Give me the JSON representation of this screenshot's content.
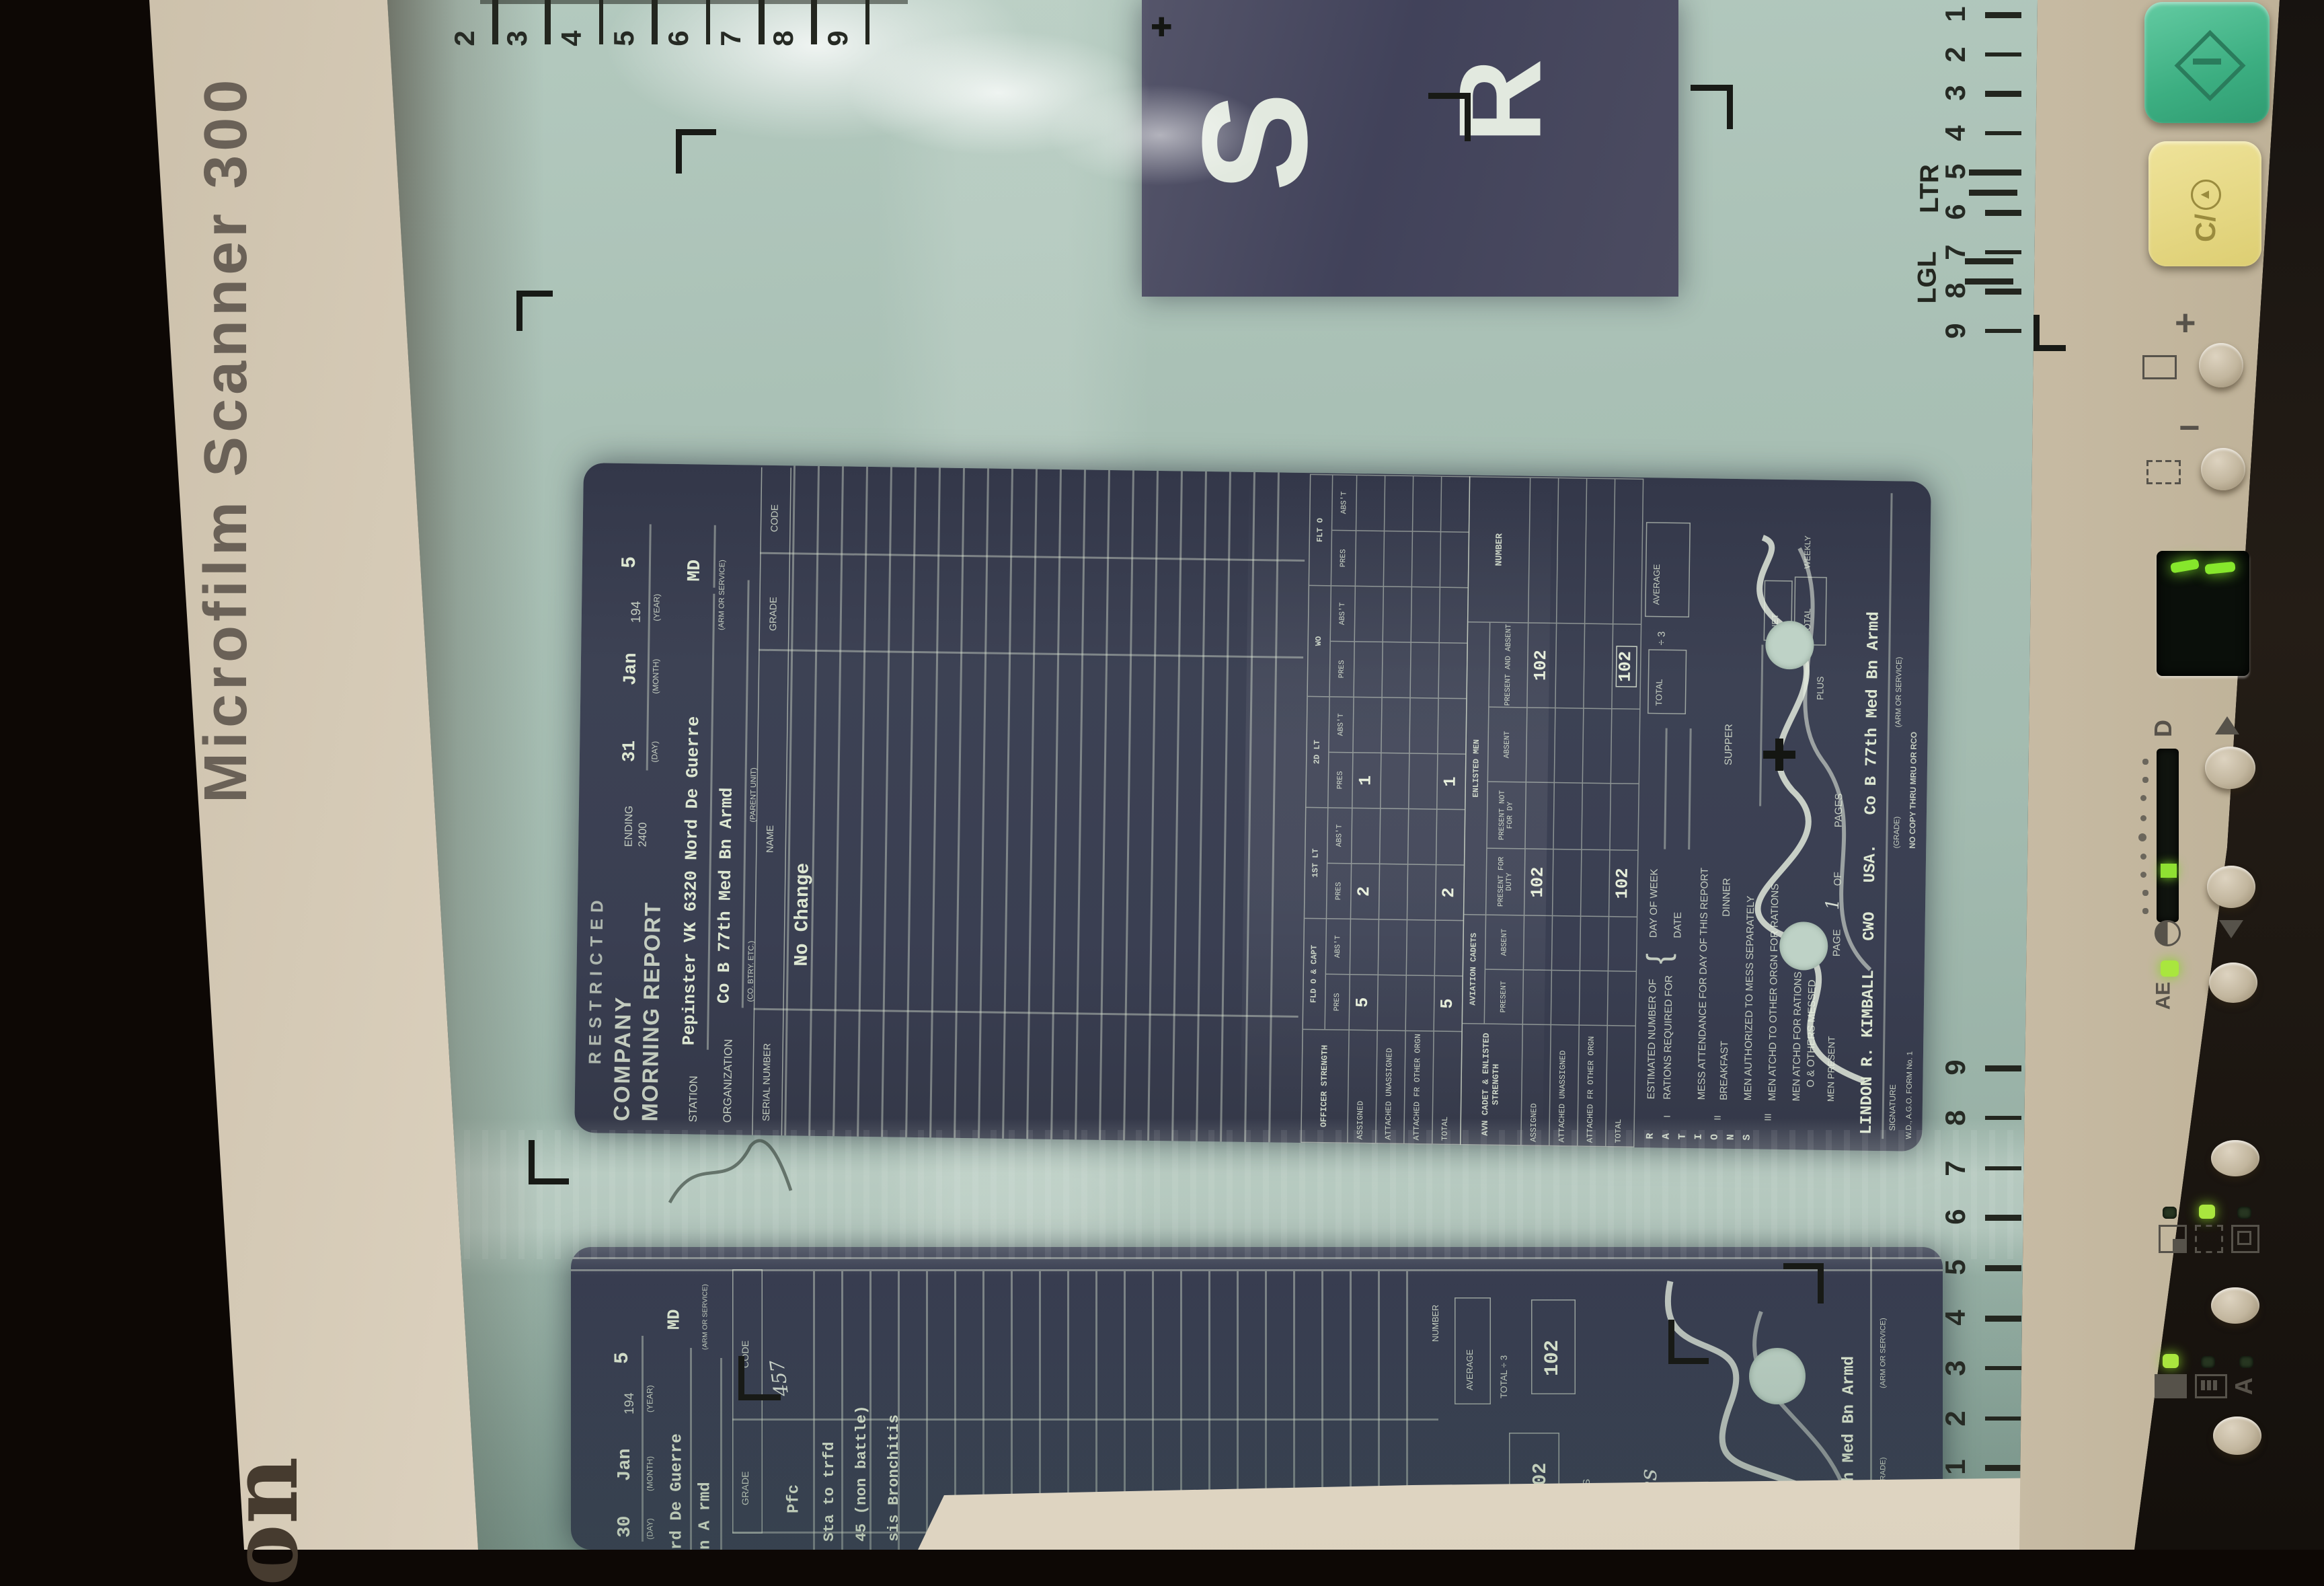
{
  "device": {
    "model_label": "Microfilm Scanner 300",
    "brand_logo_fragment": "on",
    "colors": {
      "bezel": "#d7ccb8",
      "screen_glass": "#a9c0b5",
      "document_film": "#3a3f52",
      "start_button_green": "#45b58c",
      "clear_button_yellow": "#e6da84",
      "led_green": "#a9e63e",
      "segment_green": "#86e72c",
      "ruler_ink": "#23261f"
    }
  },
  "screen": {
    "top_ruler_numbers": [
      "2",
      "3",
      "4",
      "5",
      "6",
      "7",
      "8",
      "9"
    ],
    "right_ruler_top": {
      "numbers": [
        "1",
        "2",
        "3",
        "4",
        "5",
        "6",
        "7",
        "8",
        "9"
      ],
      "letter_label": "LTR",
      "legal_label": "LGL"
    },
    "right_ruler_bottom_numbers": [
      "9",
      "8",
      "7",
      "6",
      "5",
      "4",
      "3",
      "2",
      "1"
    ],
    "film_title_letters": {
      "letter1": "S",
      "letter2": "R"
    }
  },
  "main_document": {
    "classification_stamp": "RESTRICTED",
    "title_line1": "COMPANY",
    "title_line2": "MORNING REPORT",
    "ending_label": "ENDING",
    "ending_time": "2400",
    "date": {
      "day": "31",
      "month": "Jan",
      "year_printed": "194",
      "year_written": "5",
      "day_label": "(DAY)",
      "month_label": "(MONTH)",
      "year_label": "(YEAR)"
    },
    "station_label": "STATION",
    "station_value": "Pepinster VK 6320 Nord De Guerre",
    "arm_value": "MD",
    "arm_label": "(ARM OR SERVICE)",
    "organization_label": "ORGANIZATION",
    "organization_value": "Co B 77th Med Bn Armd",
    "organization_sub": "(CO. BTRY. ETC.)",
    "parent_unit_label": "(PARENT UNIT)",
    "roster": {
      "headers": [
        "SERIAL NUMBER",
        "NAME",
        "GRADE",
        "CODE"
      ],
      "entry": "No Change"
    },
    "officer_table": {
      "label": "OFFICER STRENGTH",
      "groups": [
        "FLD O & CAPT",
        "1ST LT",
        "2D LT",
        "WO",
        "FLT O"
      ],
      "sub": [
        "PRES",
        "ABS'T"
      ],
      "rows": [
        {
          "label": "ASSIGNED",
          "values": [
            "5",
            "",
            "2",
            "",
            "1",
            "",
            "",
            "",
            "",
            ""
          ]
        },
        {
          "label": "ATTACHED UNASSIGNED",
          "values": [
            "",
            "",
            "",
            "",
            "",
            "",
            "",
            "",
            "",
            ""
          ]
        },
        {
          "label": "ATTACHED FR OTHER ORGN",
          "values": [
            "",
            "",
            "",
            "",
            "",
            "",
            "",
            "",
            "",
            ""
          ]
        },
        {
          "label": "TOTAL",
          "values": [
            "5",
            "",
            "2",
            "",
            "1",
            "",
            "",
            "",
            "",
            ""
          ]
        }
      ]
    },
    "cadet_table": {
      "label": "AVN CADET & ENLISTED STRENGTH",
      "group1": "AVIATION CADETS",
      "group2": "ENLISTED MEN",
      "number_header": "NUMBER",
      "sub": [
        "PRESENT",
        "ABSENT",
        "PRESENT FOR DUTY",
        "PRESENT NOT FOR DY",
        "ABSENT",
        "PRESENT AND ABSENT"
      ],
      "rows": [
        {
          "label": "ASSIGNED",
          "values": [
            "",
            "",
            "102",
            "",
            "",
            "102"
          ],
          "number": "",
          "boxed": -1
        },
        {
          "label": "ATTACHED UNASSIGNED",
          "values": [
            "",
            "",
            "",
            "",
            "",
            ""
          ],
          "number": "",
          "boxed": -1
        },
        {
          "label": "ATTACHED FR OTHER ORGN",
          "values": [
            "",
            "",
            "",
            "",
            "",
            ""
          ],
          "number": "",
          "boxed": -1
        },
        {
          "label": "TOTAL",
          "values": [
            "",
            "",
            "102",
            "",
            "",
            "102"
          ],
          "number": "",
          "boxed": 5
        }
      ]
    },
    "rations": {
      "section_label": "RATIONS",
      "numeral_1": "I",
      "numeral_2": "II",
      "numeral_3": "III",
      "estimated_line1": "ESTIMATED NUMBER OF",
      "estimated_line2": "RATIONS REQUIRED FOR",
      "day_of_week_label": "DAY OF WEEK",
      "date_label": "DATE",
      "total_label": "TOTAL",
      "divide_label": "÷ 3",
      "average_label": "AVERAGE",
      "mess_attendance_label": "MESS ATTENDANCE FOR DAY OF THIS REPORT",
      "breakfast_label": "BREAKFAST",
      "dinner_label": "DINNER",
      "supper_label": "SUPPER",
      "mess_separately_label": "MEN AUTHORIZED TO MESS SEPARATELY",
      "atchd_other_label": "MEN ATCHD TO OTHER ORGN FOR RATIONS",
      "atchd_rations_line1": "MEN ATCHD FOR RATIONS",
      "atchd_rations_line2": "O & OTHERS MESSED",
      "net_label": "NET",
      "plus_label": "PLUS",
      "weekly_label": "WEEKLY",
      "total2_label": "TOTAL",
      "men_present_label": "MEN PRESENT"
    },
    "signature_block": {
      "page_label": "PAGE",
      "page_value": "1",
      "of_label": "OF",
      "pages_label": "PAGES",
      "signer_line": "LINDON R. KIMBALL   CWO   USA.   Co B 77th Med Bn Armd",
      "signature_label": "SIGNATURE",
      "grade_label": "(GRADE)",
      "arm_label": "(ARM OR SERVICE)",
      "form_number": "W.D., A.G.O. FORM No. 1",
      "copy_note": "NO COPY THRU MRU OR RCO"
    }
  },
  "next_document": {
    "date": {
      "day": "30",
      "month": "Jan",
      "year_printed": "194",
      "year_written": "5",
      "day_label": "(DAY)",
      "month_label": "(MONTH)",
      "year_label": "(YEAR)"
    },
    "station_fragment": "rd De Guerre",
    "arm_value": "MD",
    "organization_fragment": "n A rmd",
    "arm_label": "(ARM OR SERVICE)",
    "grade_header": "GRADE",
    "code_header": "CODE",
    "entry_grade": "Pfc",
    "code_written": "457",
    "entry_line1": "Sta to trfd",
    "entry_line2": "45 (non battle)",
    "entry_line3": "sis Bronchitis",
    "number_label": "NUMBER",
    "average_label": "AVERAGE",
    "divide_note": "TOTAL ÷ 3",
    "total_label": "TOTAL",
    "total_value": "102",
    "number_value": "102",
    "plus_label": "PLUS",
    "page_written": "ges",
    "organization_line": "o B 77th Med Bn Armd",
    "grade_label": "(GRADE)",
    "arm_sub_label": "(ARM OR SERVICE)"
  },
  "control_panel": {
    "start_button_icon": "diamond-bar-icon",
    "clear_button_label": "C/",
    "zoom_in_label": "+",
    "zoom_out_label": "−",
    "display_value": "1",
    "density_label": "D",
    "auto_exposure_label": "AE",
    "auto_label": "A",
    "up_arrow_icon": "triangle-up-icon",
    "down_arrow_icon": "triangle-down-icon"
  }
}
